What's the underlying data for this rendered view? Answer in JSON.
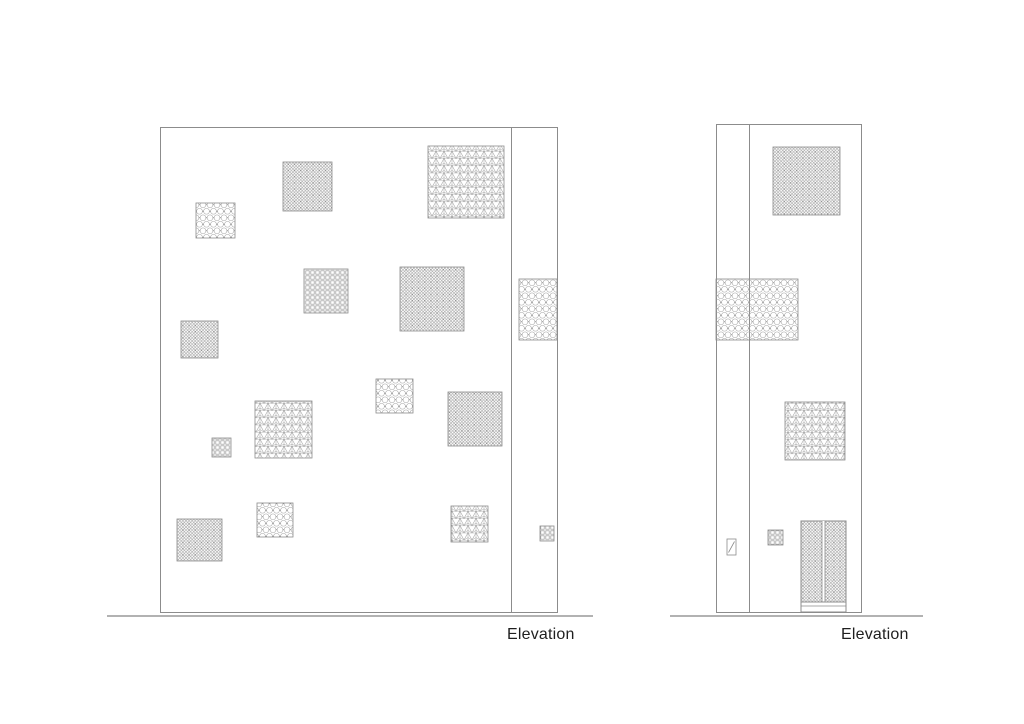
{
  "title": "Architectural elevation drawings with patterned screen panels",
  "style": {
    "background": "#ffffff",
    "wall_line_color": "#8c8c8c",
    "ground_line_color": "#b2b2b2",
    "pattern_line_color": "#a0a0a0",
    "pattern_dot_color": "#6e6e6e",
    "text_color": "#1f1f1f"
  },
  "elevations": [
    {
      "name": "front-elevation",
      "label": "Elevation",
      "label_pos": {
        "x": 507,
        "y": 626
      },
      "wall": {
        "x": 160,
        "y": 127,
        "w": 397,
        "h": 485
      },
      "inner_line_x": 511,
      "ground": {
        "x1": 107,
        "x2": 593,
        "y": 616
      },
      "panels": [
        {
          "pattern": "hexagon",
          "x": 196,
          "y": 203,
          "w": 39,
          "h": 35
        },
        {
          "pattern": "shippo",
          "x": 283,
          "y": 162,
          "w": 49,
          "h": 49
        },
        {
          "pattern": "asanoha",
          "x": 428,
          "y": 146,
          "w": 76,
          "h": 72
        },
        {
          "pattern": "grid",
          "x": 304,
          "y": 269,
          "w": 44,
          "h": 44
        },
        {
          "pattern": "shippo",
          "x": 400,
          "y": 267,
          "w": 64,
          "h": 64
        },
        {
          "pattern": "shippo",
          "x": 181,
          "y": 321,
          "w": 37,
          "h": 37
        },
        {
          "pattern": "hexagon",
          "x": 519,
          "y": 279,
          "w": 38,
          "h": 61
        },
        {
          "pattern": "hexagon",
          "x": 376,
          "y": 379,
          "w": 37,
          "h": 34
        },
        {
          "pattern": "asanoha",
          "x": 255,
          "y": 401,
          "w": 57,
          "h": 57
        },
        {
          "pattern": "grid",
          "x": 212,
          "y": 438,
          "w": 19,
          "h": 19
        },
        {
          "pattern": "shippo",
          "x": 448,
          "y": 392,
          "w": 54,
          "h": 54
        },
        {
          "pattern": "shippo",
          "x": 177,
          "y": 519,
          "w": 45,
          "h": 42
        },
        {
          "pattern": "hexagon",
          "x": 257,
          "y": 503,
          "w": 36,
          "h": 34
        },
        {
          "pattern": "asanoha",
          "x": 451,
          "y": 506,
          "w": 37,
          "h": 36
        },
        {
          "pattern": "grid",
          "x": 540,
          "y": 526,
          "w": 14,
          "h": 15
        }
      ]
    },
    {
      "name": "side-elevation",
      "label": "Elevation",
      "label_pos": {
        "x": 841,
        "y": 626
      },
      "wall": {
        "x": 716,
        "y": 124,
        "w": 145,
        "h": 488
      },
      "inner_line_x": 749,
      "ground": {
        "x1": 670,
        "x2": 923,
        "y": 616
      },
      "panels": [
        {
          "pattern": "shippo",
          "x": 773,
          "y": 147,
          "w": 67,
          "h": 68
        },
        {
          "pattern": "hexagon",
          "x": 716,
          "y": 279,
          "w": 82,
          "h": 61
        },
        {
          "pattern": "asanoha",
          "x": 785,
          "y": 402,
          "w": 60,
          "h": 58
        },
        {
          "pattern": "grid",
          "x": 768,
          "y": 530,
          "w": 15,
          "h": 15
        }
      ],
      "door": {
        "pattern": "shippo",
        "x": 801,
        "y": 521,
        "w": 45,
        "h": 81,
        "threshold_h": 10
      },
      "sign": {
        "x": 727,
        "y": 539,
        "w": 9,
        "h": 16
      }
    }
  ]
}
